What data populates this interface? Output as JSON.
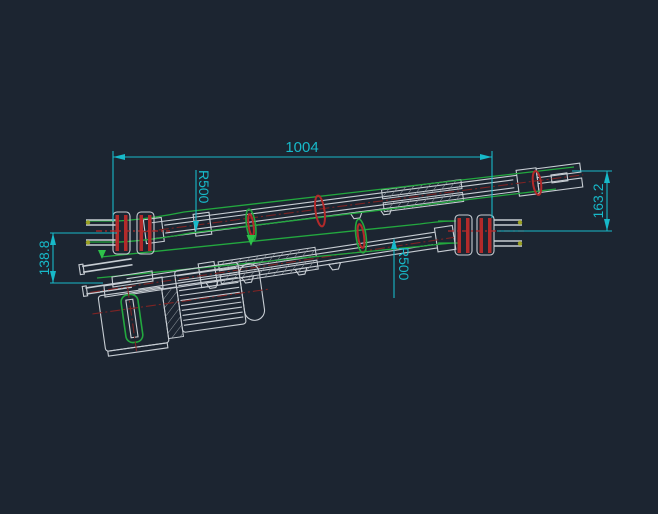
{
  "canvas": {
    "background": "#1c2531"
  },
  "colors": {
    "background": "#1c2531",
    "dim": "#17b9c9",
    "geo": "#c7cdd3",
    "belt": "#23a83f",
    "arrow_green": "#2ec24a",
    "red": "#b32a2a",
    "center": "#7e2424",
    "dot": "#9aa023",
    "hatch": "#8f979e"
  },
  "dimensions": {
    "overall_length": {
      "label": "1004"
    },
    "radius_top": {
      "label": "R500"
    },
    "radius_bottom": {
      "label": "R500"
    },
    "height_right": {
      "label": "163.2"
    },
    "height_left": {
      "label": "138.8"
    }
  }
}
